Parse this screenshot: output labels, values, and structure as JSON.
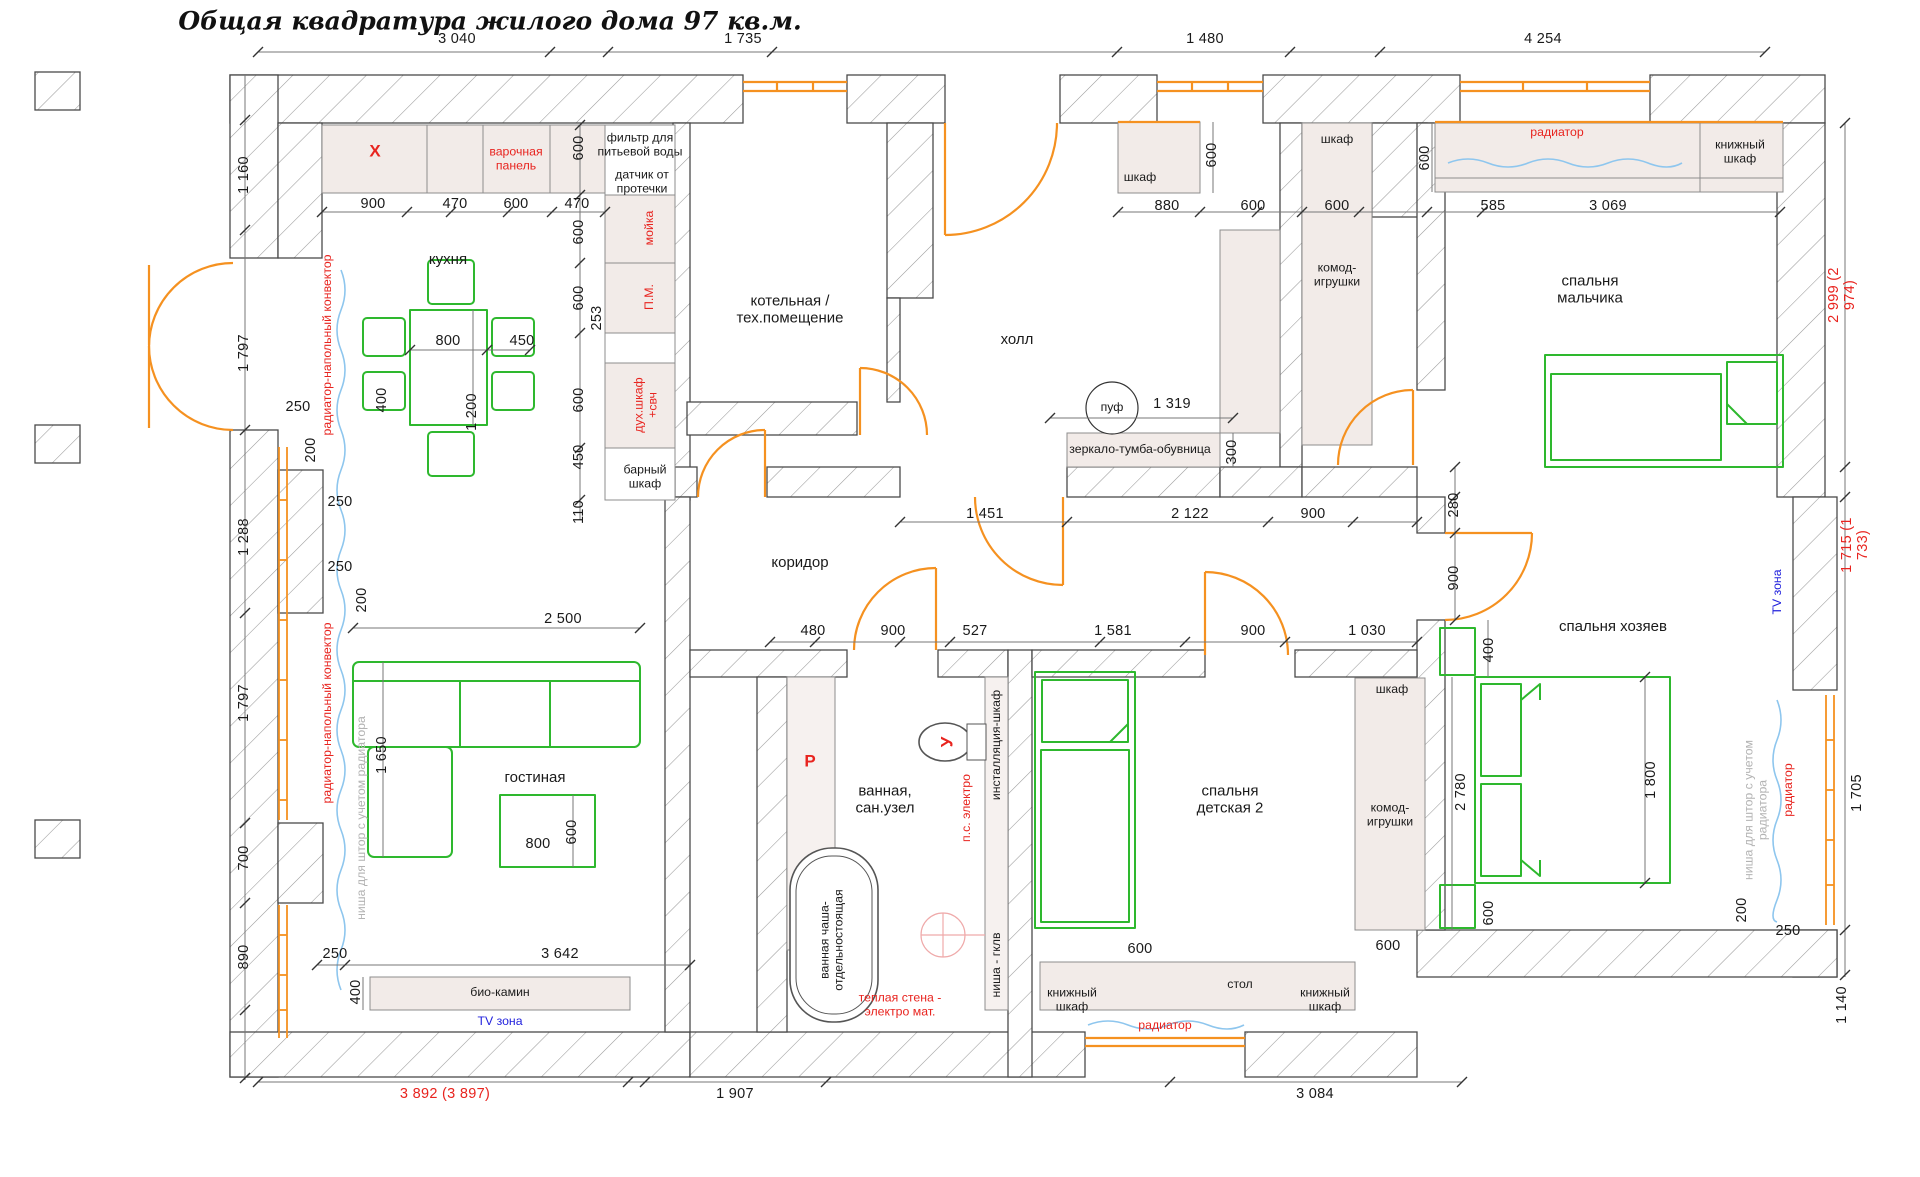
{
  "title": "Общая квадратура жилого дома 97 кв.м.",
  "rooms": {
    "kitchen": "кухня",
    "boiler": "котельная /\nтех.помещение",
    "hall": "холл",
    "boy": "спальня\nмальчика",
    "corridor": "коридор",
    "living": "гостиная",
    "bath": "ванная,\nсан.узел",
    "child": "спальня\nдетская 2",
    "master": "спальня хозяев"
  },
  "fx": {
    "x": "X",
    "hob": "варочная\nпанель",
    "filter": "фильтр для\nпитьевой воды",
    "sensor": "датчик от\nпротечки",
    "sink": "мойка",
    "pm": "П.М.",
    "oven": "дух.шкаф\n+свч",
    "bar": "барный\nшкаф",
    "conv": "радиатор-напольный конвектор",
    "curt": "ниша для штор с учетом радиатора",
    "rad": "радиатор",
    "ward": "шкаф",
    "komod": "комод-\nигрушки",
    "book": "книжный\nшкаф",
    "mirror": "зеркало-тумба-обувница",
    "puf": "пуф",
    "bio": "био-камин",
    "tv": "TV зона",
    "desk": "стол",
    "inst": "инсталляция-шкаф",
    "gklv": "ниша - гклв",
    "tub": "ванная чаша-\nотдельностоящая",
    "warm": "теплая стена -\nэлектро мат.",
    "ps": "п.с. электро",
    "r": "Р",
    "u": "У"
  },
  "dims": {
    "t1": "3 040",
    "t2": "1 735",
    "t3": "1 480",
    "t4": "4 254",
    "l1": "1 160",
    "l2": "1 797",
    "l3": "1 288",
    "l4": "1 797",
    "l5": "700",
    "l6": "890",
    "r1": "2 999 (2 974)",
    "r2": "1 715 (1 733)",
    "r3": "1 705",
    "r4": "1 140",
    "b1": "3 892 (3 897)",
    "b2": "1 907",
    "b3": "3 084",
    "k1": "900",
    "k2": "470",
    "k3": "600",
    "k4": "470",
    "k5": "600",
    "k6": "600",
    "k7": "600",
    "k8": "253",
    "k9": "600",
    "k10": "450",
    "k11": "110",
    "k12": "800",
    "k13": "450",
    "k14": "400",
    "k15": "1 200",
    "k16": "250",
    "k17": "200",
    "k18": "250",
    "k19": "250",
    "k20": "200",
    "h1": "880",
    "h2": "600",
    "h3": "600",
    "h4": "600",
    "h5": "585",
    "h6": "3 069",
    "h7": "1 319",
    "h8": "300",
    "h9": "600",
    "c1": "1 451",
    "c2": "2 122",
    "c3": "900",
    "c4": "280",
    "c5": "900",
    "c6": "480",
    "c7": "900",
    "c8": "527",
    "c9": "1 581",
    "c10": "900",
    "c11": "1 030",
    "g1": "2 500",
    "g2": "1 650",
    "g3": "800",
    "g4": "600",
    "g5": "3 642",
    "g6": "250",
    "g7": "400",
    "m1": "400",
    "m2": "2 780",
    "m3": "1 800",
    "m4": "600",
    "m5": "200",
    "m6": "250",
    "ch1": "600",
    "ch2": "600"
  },
  "colors": {
    "orange": "#f59120",
    "green": "#2eb82e",
    "wave": "#8ec6ee",
    "red": "#e8241f",
    "blue": "#2222dd",
    "gray": "#b3b3b3",
    "cabinet": "#f2ebe8"
  }
}
